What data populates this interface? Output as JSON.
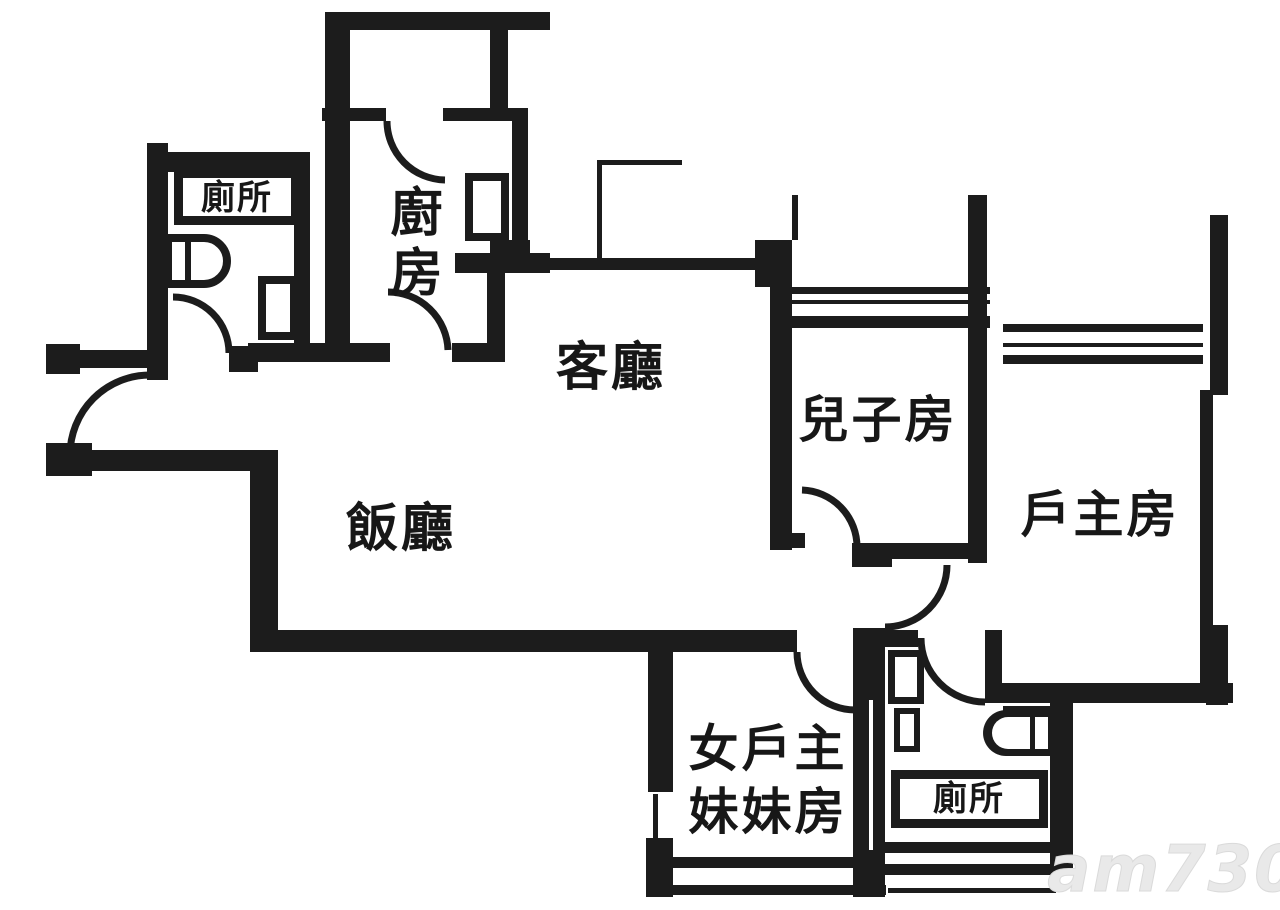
{
  "document": {
    "type": "floor-plan",
    "description": "Black and white apartment floor plan with Chinese room labels"
  },
  "colors": {
    "ink": "#1c1c1c",
    "background": "#ffffff",
    "watermark": "#e9e9e9"
  },
  "rooms": [
    {
      "id": "toilet-upper",
      "label": "廁所",
      "boxed": true
    },
    {
      "id": "kitchen",
      "label": "廚房",
      "lines": [
        "廚",
        "房"
      ],
      "orientation": "vertical"
    },
    {
      "id": "living-room",
      "label": "客廳"
    },
    {
      "id": "dining-room",
      "label": "飯廳"
    },
    {
      "id": "sons-room",
      "label": "兒子房"
    },
    {
      "id": "master-room",
      "label": "戶主房"
    },
    {
      "id": "sisters-room",
      "label": "女戶主妹妹房",
      "lines": [
        "女戶主",
        "妹妹房"
      ]
    },
    {
      "id": "toilet-lower",
      "label": "廁所",
      "boxed": true
    }
  ],
  "watermark": {
    "text": "am730"
  }
}
